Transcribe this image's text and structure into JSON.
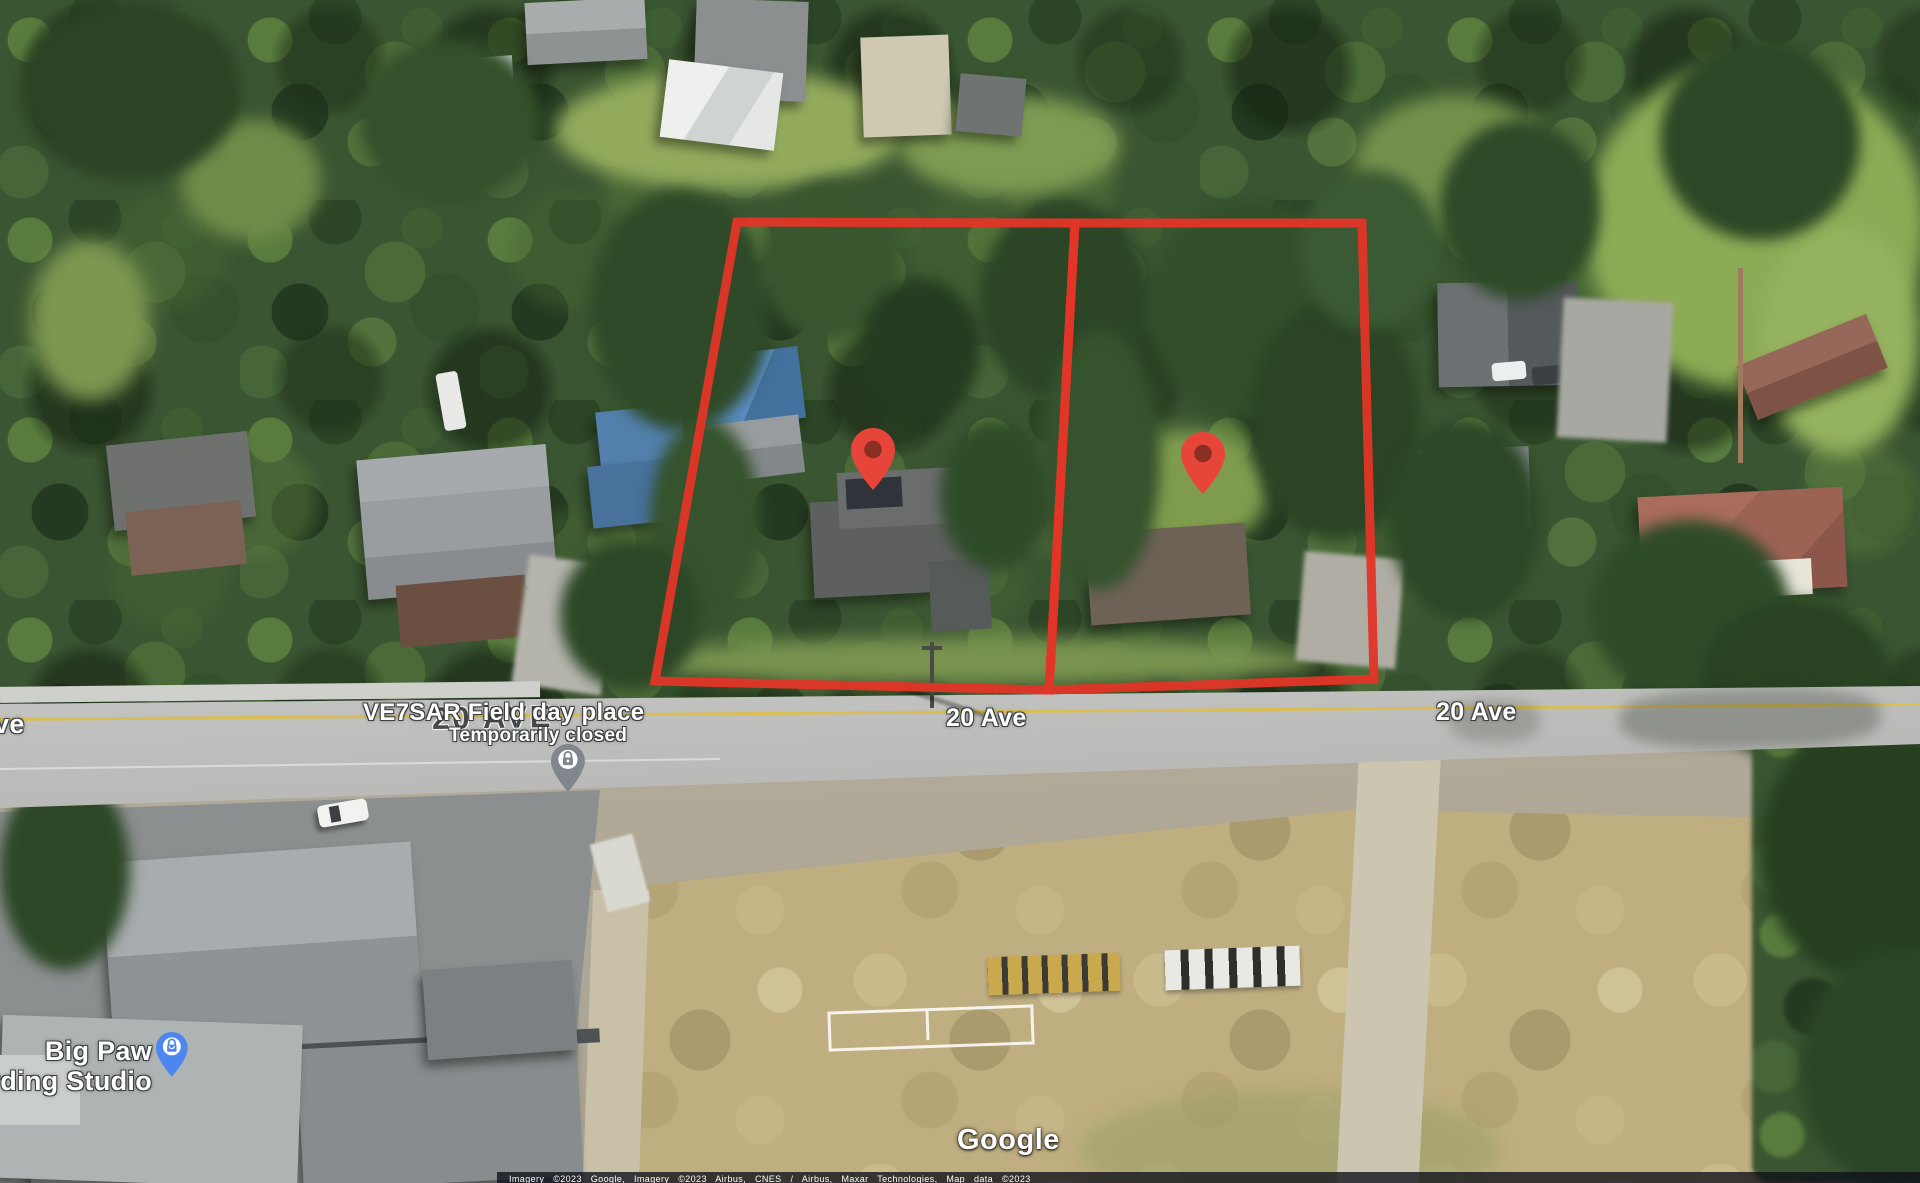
{
  "labels": {
    "road_left_partial": "ve",
    "road_center": "20 Ave",
    "road_right": "20 Ave",
    "road_hidden": "20 AVE",
    "poi_title": "VE7SAR Field day place",
    "poi_status": "Temporarily closed",
    "studio_line1": "Big Paw",
    "studio_line2": "Recording Studio",
    "watermark": "Google",
    "attribution": "Imagery ©2023 Google, Imagery ©2023 Airbus, CNES / Airbus, Maxar Technologies, Map data ©2023"
  },
  "markers": {
    "property_pin_west": {
      "icon": "location-pin-icon",
      "color": "#e8453a",
      "inner_color": "#8a2f23"
    },
    "property_pin_east": {
      "icon": "location-pin-icon",
      "color": "#e8453a",
      "inner_color": "#8a2f23"
    },
    "ve7sar_pin": {
      "icon": "temporarily-closed-pin-icon",
      "color": "#80868b"
    },
    "big_paw_pin": {
      "icon": "shopping-bag-pin-icon",
      "color": "#4e86f0"
    }
  },
  "parcels": {
    "outline_color": "#e03528",
    "count": 2
  },
  "scene_colors": {
    "canopy": "#3a5531",
    "lawn": "#8fae57",
    "field": "#bfae80",
    "road": "#c0c0be",
    "school_roof": "#8f9496",
    "blue_tarp": "#4f81b4",
    "red_roof": "#9c6355"
  }
}
